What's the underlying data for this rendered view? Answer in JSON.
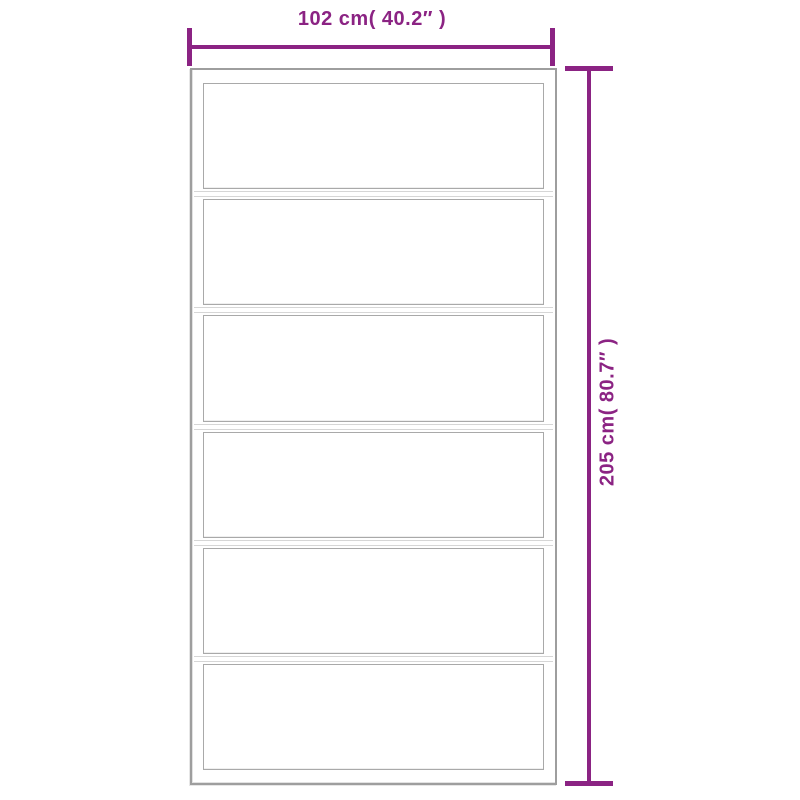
{
  "diagram": {
    "type": "product-dimension-diagram",
    "subject": "six-panel glass sliding door outline drawing",
    "width_dimension": {
      "label": "102 cm( 40.2″ )",
      "value_cm": 102,
      "value_inch": 40.2,
      "position": "top"
    },
    "height_dimension": {
      "label": "205 cm( 80.7″ )",
      "value_cm": 205,
      "value_inch": 80.7,
      "position": "right",
      "text_rotation_deg": -90
    },
    "door": {
      "panel_count": 6
    },
    "colors": {
      "accent": "#8B2383",
      "frame": "#9e9e9e",
      "panel_border": "#a9a9a9",
      "rail_line": "#d6d6d6",
      "background": "#ffffff"
    }
  }
}
